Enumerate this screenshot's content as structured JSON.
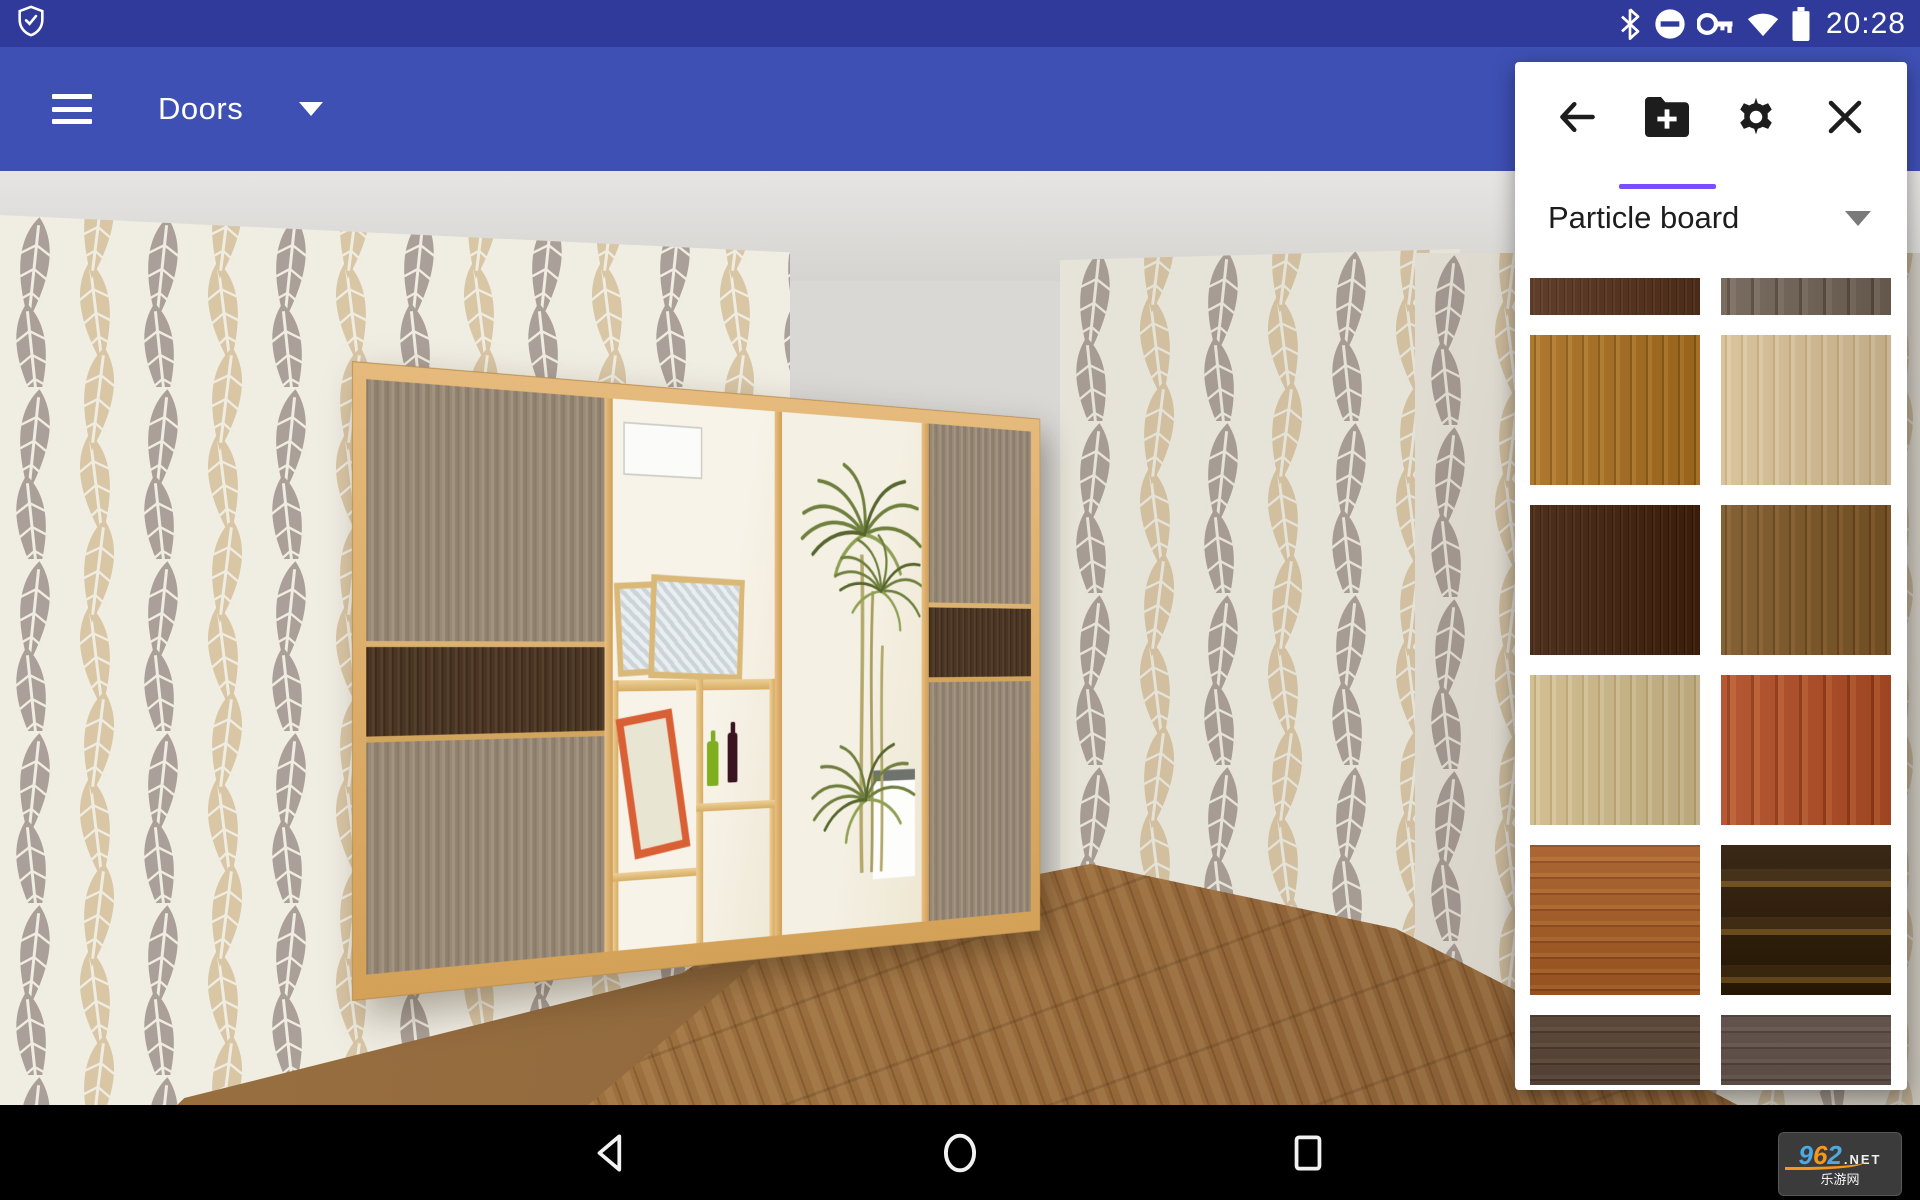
{
  "status_bar": {
    "time": "20:28",
    "left_icon": "shield-check-icon",
    "right_icons": [
      "bluetooth-icon",
      "do-not-disturb-icon",
      "vpn-key-icon",
      "wifi-icon",
      "battery-icon"
    ],
    "bar_color": "#2f3a9b"
  },
  "app_bar": {
    "title": "Doors",
    "menu_icon": "hamburger-icon",
    "title_caret_icon": "caret-down-icon",
    "bar_color": "#3e50b4"
  },
  "panel": {
    "header": {
      "buttons": [
        {
          "name": "back",
          "icon": "arrow-left-icon",
          "active": false
        },
        {
          "name": "add-folder",
          "icon": "folder-plus-icon",
          "active": true
        },
        {
          "name": "settings",
          "icon": "gear-icon",
          "active": false
        },
        {
          "name": "close",
          "icon": "close-icon",
          "active": false
        }
      ],
      "active_underline_color": "#7C4DFF"
    },
    "material_select": {
      "value": "Particle board",
      "caret_icon": "caret-down-icon"
    },
    "swatches": [
      {
        "name": "dark-red-brown",
        "direction": "vertical",
        "scale": 1,
        "partial": "top",
        "colors": [
          "#53301b",
          "#46261a",
          "#5b3a20"
        ]
      },
      {
        "name": "gray-bark",
        "direction": "vertical",
        "scale": 3,
        "partial": "top",
        "colors": [
          "#6f6154",
          "#574a3e",
          "#7a6d60"
        ]
      },
      {
        "name": "golden-oak",
        "direction": "vertical",
        "scale": 2,
        "partial": null,
        "colors": [
          "#a86e20",
          "#8d5a12",
          "#b57d2e"
        ]
      },
      {
        "name": "light-oak",
        "direction": "vertical",
        "scale": 2,
        "partial": null,
        "colors": [
          "#d6bf96",
          "#c7ae7e",
          "#dfcaa4"
        ]
      },
      {
        "name": "espresso",
        "direction": "vertical",
        "scale": 1,
        "partial": null,
        "colors": [
          "#40200c",
          "#301505",
          "#4b2a12"
        ]
      },
      {
        "name": "walnut",
        "direction": "vertical",
        "scale": 2,
        "partial": null,
        "colors": [
          "#7b5526",
          "#66431a",
          "#875f2e"
        ]
      },
      {
        "name": "cream-birch",
        "direction": "vertical",
        "scale": 2,
        "partial": null,
        "colors": [
          "#ceba8b",
          "#bfa872",
          "#d8c59a"
        ]
      },
      {
        "name": "red-cherry",
        "direction": "vertical",
        "scale": 3,
        "partial": null,
        "colors": [
          "#b04c24",
          "#933915",
          "#bc5c30"
        ]
      },
      {
        "name": "calvados",
        "direction": "horizontal",
        "scale": 2,
        "partial": null,
        "colors": [
          "#a55b23",
          "#90481a",
          "#b26a2e"
        ]
      },
      {
        "name": "rosewood-stripe",
        "direction": "horizontal",
        "scale": 6,
        "partial": null,
        "colors": [
          "#2a1804",
          "#6b4a17",
          "#3c270c"
        ]
      },
      {
        "name": "dark-walnut",
        "direction": "horizontal",
        "scale": 2,
        "partial": "bottom",
        "colors": [
          "#4e3b2d",
          "#3d2c20",
          "#584536"
        ]
      },
      {
        "name": "gray-walnut",
        "direction": "horizontal",
        "scale": 2,
        "partial": "bottom",
        "colors": [
          "#574740",
          "#453630",
          "#61514a"
        ]
      }
    ]
  },
  "scene": {
    "items": [
      "wardrobe-with-sliding-doors",
      "mirror-door",
      "open-shelf-section",
      "palm-plant-reflection",
      "fern-wallpaper-left-wall",
      "fern-wallpaper-right-wall",
      "wood-plank-floor",
      "ceiling"
    ],
    "colors": {
      "pine_frame": "#e0b273",
      "gray_door_wood": "#998a78",
      "dark_door_band": "#4a3423",
      "wallpaper_bg": "#f0ede3",
      "wallpaper_leaf_taupe": "#aba099",
      "wallpaper_leaf_beige": "#d9c6a5",
      "floor_wood": "#96693a",
      "plant_green": "#6f7f3e"
    }
  },
  "nav_bar": {
    "buttons": [
      "back",
      "home",
      "recents"
    ],
    "icons": [
      "nav-back-icon",
      "nav-home-icon",
      "nav-recents-icon"
    ]
  },
  "watermark": {
    "site": "962",
    "site_colors": [
      "#4fa8e0",
      "#f5971d",
      "#4fa8e0"
    ],
    "tld": ".NET",
    "name": "乐游网",
    "swoosh_color": "#f5971d"
  }
}
